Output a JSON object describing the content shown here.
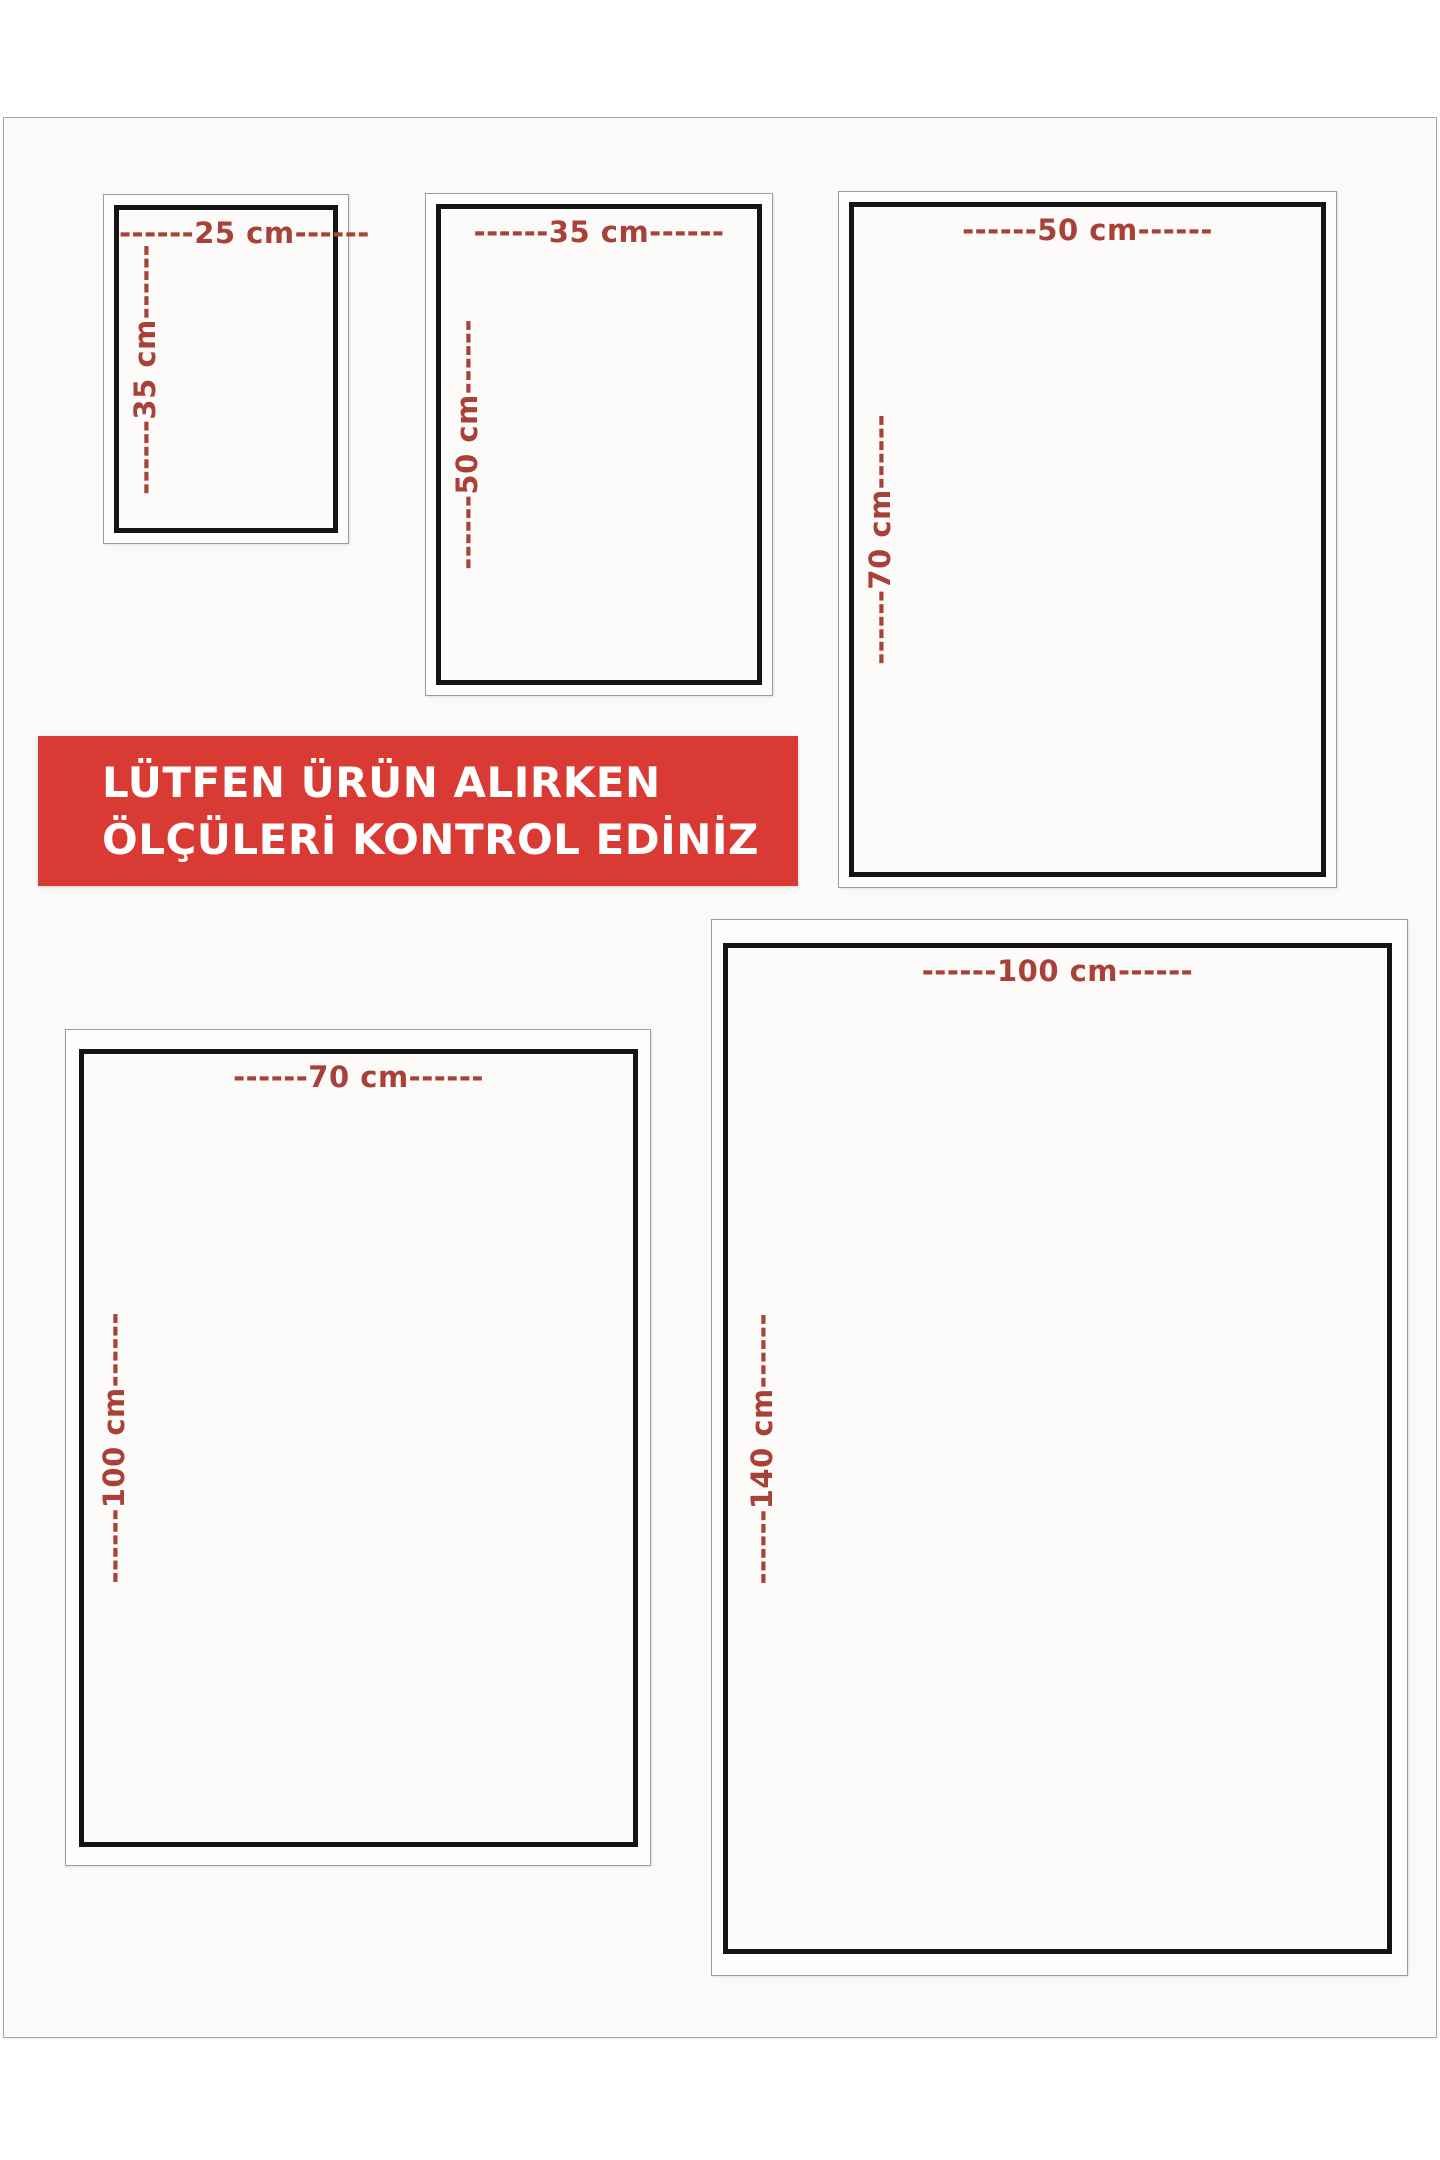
{
  "notice": {
    "line1": "LÜTFEN ÜRÜN ALIRKEN",
    "line2": "ÖLÇÜLERİ KONTROL EDİNİZ"
  },
  "colors": {
    "banner_bg": "#d93a33",
    "banner_text": "#ffffff",
    "dimension_text": "#a84138",
    "box_border": "#141414",
    "frame_border": "#9c9c9c",
    "page_bg": "#fbfaf8",
    "page_border": "#a5a5a5"
  },
  "sizes": [
    {
      "name": "25x35",
      "width_cm": 25,
      "height_cm": 35,
      "width_label": "------25 cm------",
      "height_label": "------35 cm------"
    },
    {
      "name": "35x50",
      "width_cm": 35,
      "height_cm": 50,
      "width_label": "------35 cm------",
      "height_label": "------50 cm------"
    },
    {
      "name": "50x70",
      "width_cm": 50,
      "height_cm": 70,
      "width_label": "------50 cm------",
      "height_label": "------70 cm------"
    },
    {
      "name": "70x100",
      "width_cm": 70,
      "height_cm": 100,
      "width_label": "------70 cm------",
      "height_label": "------100 cm------"
    },
    {
      "name": "100x140",
      "width_cm": 100,
      "height_cm": 140,
      "width_label": "------100 cm------",
      "height_label": "------140 cm------"
    }
  ]
}
